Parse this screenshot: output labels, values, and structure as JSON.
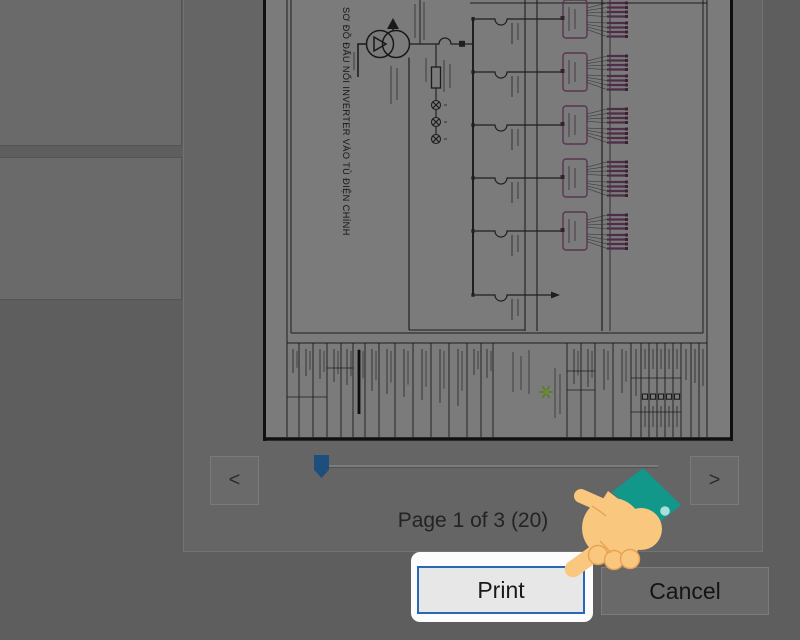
{
  "dialog": {
    "page_status": "Page 1 of 3 (20)",
    "prev_label": "<",
    "next_label": ">",
    "print_label": "Print",
    "cancel_label": "Cancel"
  },
  "preview": {
    "drawing_title_vertical": "SƠ ĐỒ ĐẤU NỐI INVERTER VÀO TỦ ĐIỆN CHÍNH"
  },
  "colors": {
    "focus_border_blue": "#2769b2",
    "slider_thumb_blue": "#1e4f7c",
    "hand_skin": "#f9c77d",
    "hand_cuff_teal": "#12978b",
    "schematic_purple": "#4e2d48",
    "logo_green": "#5c7c20",
    "dim_background": "#5e5e5e"
  }
}
